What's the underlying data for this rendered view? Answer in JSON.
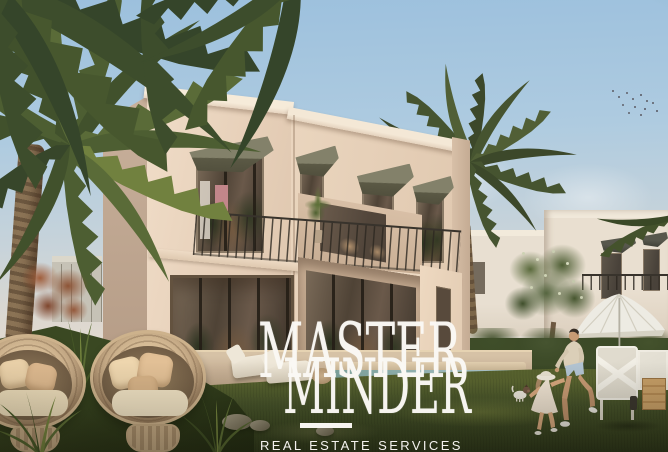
{
  "watermark": {
    "brand_line1": "MASTER",
    "brand_line2": "MINDER",
    "tagline": "REAL ESTATE SERVICES"
  },
  "colors": {
    "sky_top": "#9cc0dd",
    "sky_horizon": "#e7ddd0",
    "villa_wall_lit": "#ecd9c4",
    "villa_wall_shade": "#c9b19c",
    "awning_olive": "#6e6c57",
    "grass_dark": "#36421f",
    "grass_lit": "#59642f",
    "pool_water": "#93b3b2",
    "patio_stone": "#c8b196",
    "wicker": "#bfa380",
    "cushion": "#e2c096",
    "watermark_white": "#f7f5f1"
  }
}
